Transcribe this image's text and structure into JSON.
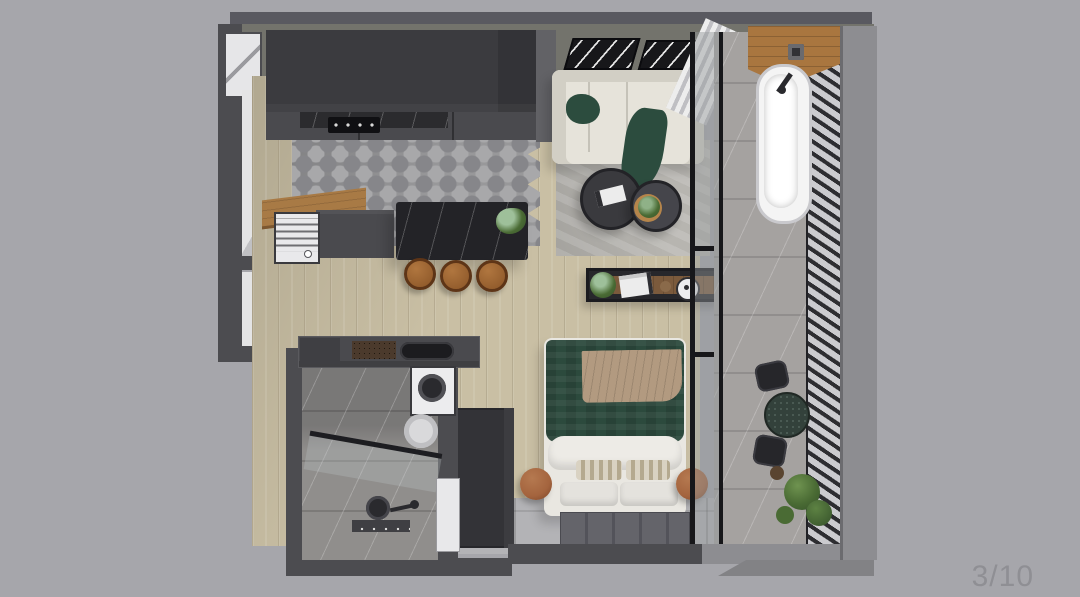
{
  "viewer": {
    "page_indicator": "3/10"
  },
  "palette": {
    "bg": "#a6a6ab",
    "page_text": "#8f8f94",
    "wall_dark": "#4c4c50",
    "wall_slab": "#595960",
    "wall_face": "#73736c",
    "wall_light": "#8d8d91",
    "wall_edge": "#6b6b6f",
    "white_face": "#e4e4e5",
    "white_face_shade": "#c0c0c3",
    "window": "#e6e6e8",
    "cabinet": "#3b3b3f",
    "cabinet_side": "#626266",
    "counter": "#4a4a4e",
    "marble_black": "#2b2b2e",
    "cooktop": "#101013",
    "hex_base": "#98989a",
    "hex_dark": "#86868a",
    "hex_light": "#a8a8aa",
    "island": "#232327",
    "stool": "#8a5527",
    "stool_edge": "#5e3517",
    "shelf_wood": "#a87a45",
    "fridge": "#e9e9eb",
    "wood": "#c9bfa4",
    "rug": "#b7b5b0",
    "sofa": "#e6e3da",
    "sofa_edge": "#d2cfc5",
    "green": "#2c4c3e",
    "table_dark": "#3a3a3e",
    "table_edge": "#232327",
    "tray": "#b5854b",
    "plant": "#4a6b34",
    "plant_dark": "#35512a",
    "curtain_a": "#ededed",
    "curtain_b": "#bfbfc3",
    "glass": "rgba(148,153,156,0.45)",
    "frame_black": "#17171a",
    "balcony_floor": "#a5a2a0",
    "marble_streak": "rgba(255,255,255,0.22)",
    "slat_bg": "#cbcbcf",
    "slat_bar": "#2d2d31",
    "counter_wood": "#a9763f",
    "tub": "#f4f4f4",
    "tub_edge": "#c9c9cd",
    "console": "#27272b",
    "wardrobe": "#333337",
    "duvet": "#2c4a3d",
    "throw_tan": "#b29a80",
    "bed_white": "#e9e7e1",
    "pillow_a": "#d9d2c2",
    "pillow_b": "#b4a98f",
    "pouf": "#a4643e",
    "pouf_dark": "#7a4326",
    "mat": "#64646a",
    "mat_line": "#53535a",
    "entry_tile": "#b3b3b6",
    "bath_floor": "#908e8c",
    "bath_wall_shade": "rgba(40,40,44,0.22)",
    "washer": "#ececee",
    "fixture": "#2a2a2e",
    "art": "#17171a"
  },
  "scene": {
    "type": "3d-floor-plan-top-view",
    "rooms": [
      {
        "name": "kitchen",
        "features": [
          "upper-cabinets",
          "cooktop",
          "marble-backsplash",
          "marble-island",
          "bar-stools",
          "mini-fridge",
          "wood-prep-shelf",
          "hex-tile-floor"
        ]
      },
      {
        "name": "living-area",
        "features": [
          "sofa",
          "green-throw-blankets",
          "area-rug",
          "round-coffee-tables",
          "book",
          "plant-on-tray",
          "wall-art-frames",
          "curtain"
        ]
      },
      {
        "name": "bedroom",
        "features": [
          "double-bed",
          "green-duvet",
          "tan-throw",
          "white-pillows",
          "striped-pillows",
          "poufs",
          "console-shelf",
          "wardrobe",
          "foot-mat"
        ]
      },
      {
        "name": "bathroom",
        "features": [
          "vanity-sink",
          "washing-machine",
          "toilet",
          "shower-glass",
          "shower-head",
          "floor-drain",
          "marble-tiles"
        ]
      },
      {
        "name": "balcony",
        "features": [
          "bathtub",
          "wood-counter",
          "slatted-screen",
          "bistro-table",
          "chairs",
          "plants",
          "glass-partition"
        ]
      }
    ]
  }
}
